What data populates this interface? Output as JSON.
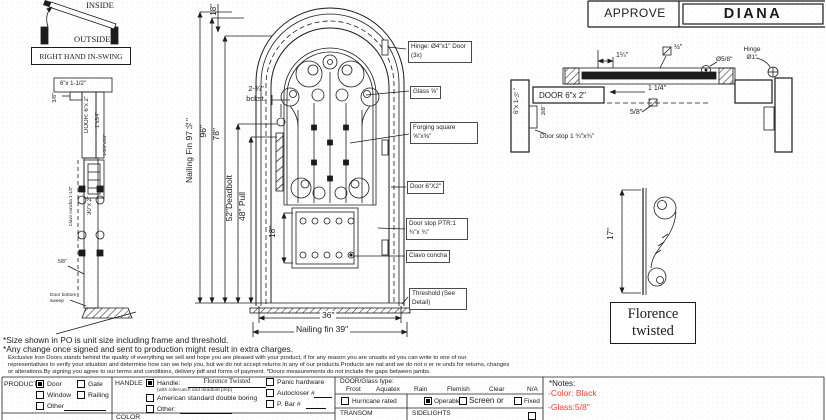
{
  "swing": {
    "inside": "INSIDE",
    "outside": "OUTSIDE",
    "label": "RIGHT HAND IN-SWING"
  },
  "left_section": {
    "head_jamb": "6\"x 1-1/2\"",
    "offset": "3/8\"",
    "door": "DOOR: 6\"x 2\"",
    "stop": "1\"x3/4\"",
    "lock_dim": "1-3/4\"x3/4\"",
    "panel": "30\"x 2\"",
    "clavo": "Clavo concha 1-1/2\"",
    "bottom_dim": "5/8\"",
    "sweep": "Door bottom sweep"
  },
  "elevation": {
    "dim_top": "18\"",
    "dim_nailing_fin": "Nailing Fin 97½\"",
    "dim_96": "96\"",
    "dim_78": "78\"",
    "dim_deadbolt": "52\"Deadbolt",
    "dim_pull": "48\" Pull",
    "dim_backset": "2-¾\" bckst.",
    "dim_panel": "18\"",
    "dim_width": "36\"",
    "dim_nailing_width": "Nailing fin 39\""
  },
  "callouts": {
    "hinge": "Hinge: Ø4\"x1\" Door (3x)",
    "glass": "Glass ⅝\"",
    "forging": "Forging square ⅝\"x⅝\"",
    "door": "Door 6\"X2\"",
    "door_stop": "Door stop PTR:1 ¾\"x ¾\"",
    "clavo": "Clavo concha",
    "threshold": "Threshold (See Detail)"
  },
  "approval": {
    "approve": "APPROVE",
    "name": "DIANA"
  },
  "h_section": {
    "jamb": "6\"x 1-½\"",
    "door": "DOOR 6\"x 2\"",
    "offset": "3/8\"",
    "door_stop": "Door stop 1 ¾\"x¾\"",
    "dim_top": "1¼\"",
    "dim_half": "½\"",
    "dim_phi": "Ø5/8\"",
    "hinge": "Hinge Ø1\"",
    "dim_bottom": "1 1/4\"",
    "dim_58": "5/8\""
  },
  "scroll_detail": {
    "dim": "17\"",
    "label": "Florence twisted"
  },
  "footnotes": {
    "size": "*Size shown in PO is unit size including frame and threshold.",
    "change": "*Any change once signed and sent to production might result in extra charges.",
    "fine1": "Exclusive Iron Doors stands behind the quality of everything we sell and hope you are pleased with your product, if for any reason you are unsatis ed you can write to one of our",
    "fine2": "representatives to verify your situation and determine how can we help you, but we do not accept returns in any of our products.Products are  nal and we do not o er re unds for returns, changes",
    "fine3": "or alterations.By signing you agree to our terms and conditions, delivery pdf and forms of payment. *Doors measurements do not include the gaps between jambs."
  },
  "form": {
    "product": {
      "label": "PRODUCT:",
      "options": [
        {
          "label": "Door",
          "checked": true
        },
        {
          "label": "Gate",
          "checked": false
        },
        {
          "label": "Window",
          "checked": false
        },
        {
          "label": "Railing",
          "checked": false
        },
        {
          "label": "Other",
          "checked": false
        }
      ]
    },
    "handle": {
      "label": "HANDLE",
      "handle_label": "Handle:",
      "handle_checked": true,
      "handle_value": "Florence Twisted",
      "handle_note": "(with rollercatch and deadbolt prep)",
      "boring": "American standard double boring",
      "boring_checked": false,
      "other": "Other:",
      "other_checked": false,
      "panic": "Panic hardware",
      "panic_checked": false,
      "autocloser": "Autocloser #",
      "autocloser_checked": false,
      "pbar": "P. Bar #",
      "pbar_checked": false
    },
    "color_label": "COLOR",
    "glass": {
      "header": "DOOR/Glass type:",
      "types": [
        "Frost",
        "Aquatex",
        "Rain",
        "Flemish",
        "Clear",
        "N/A"
      ],
      "hurricane": "Hurricane rated",
      "hurricane_checked": false,
      "operable": "Operable",
      "operable_checked": true,
      "screen": "Screen or",
      "screen_checked": false,
      "fixed": "Fixed",
      "fixed_checked": false,
      "transom": "TRANSOM",
      "sidelights": "SIDELIGHTS"
    },
    "notes": {
      "header": "*Notes:",
      "color_note": "-Color: Black",
      "glass_note": "-Glass:5/8\""
    }
  }
}
